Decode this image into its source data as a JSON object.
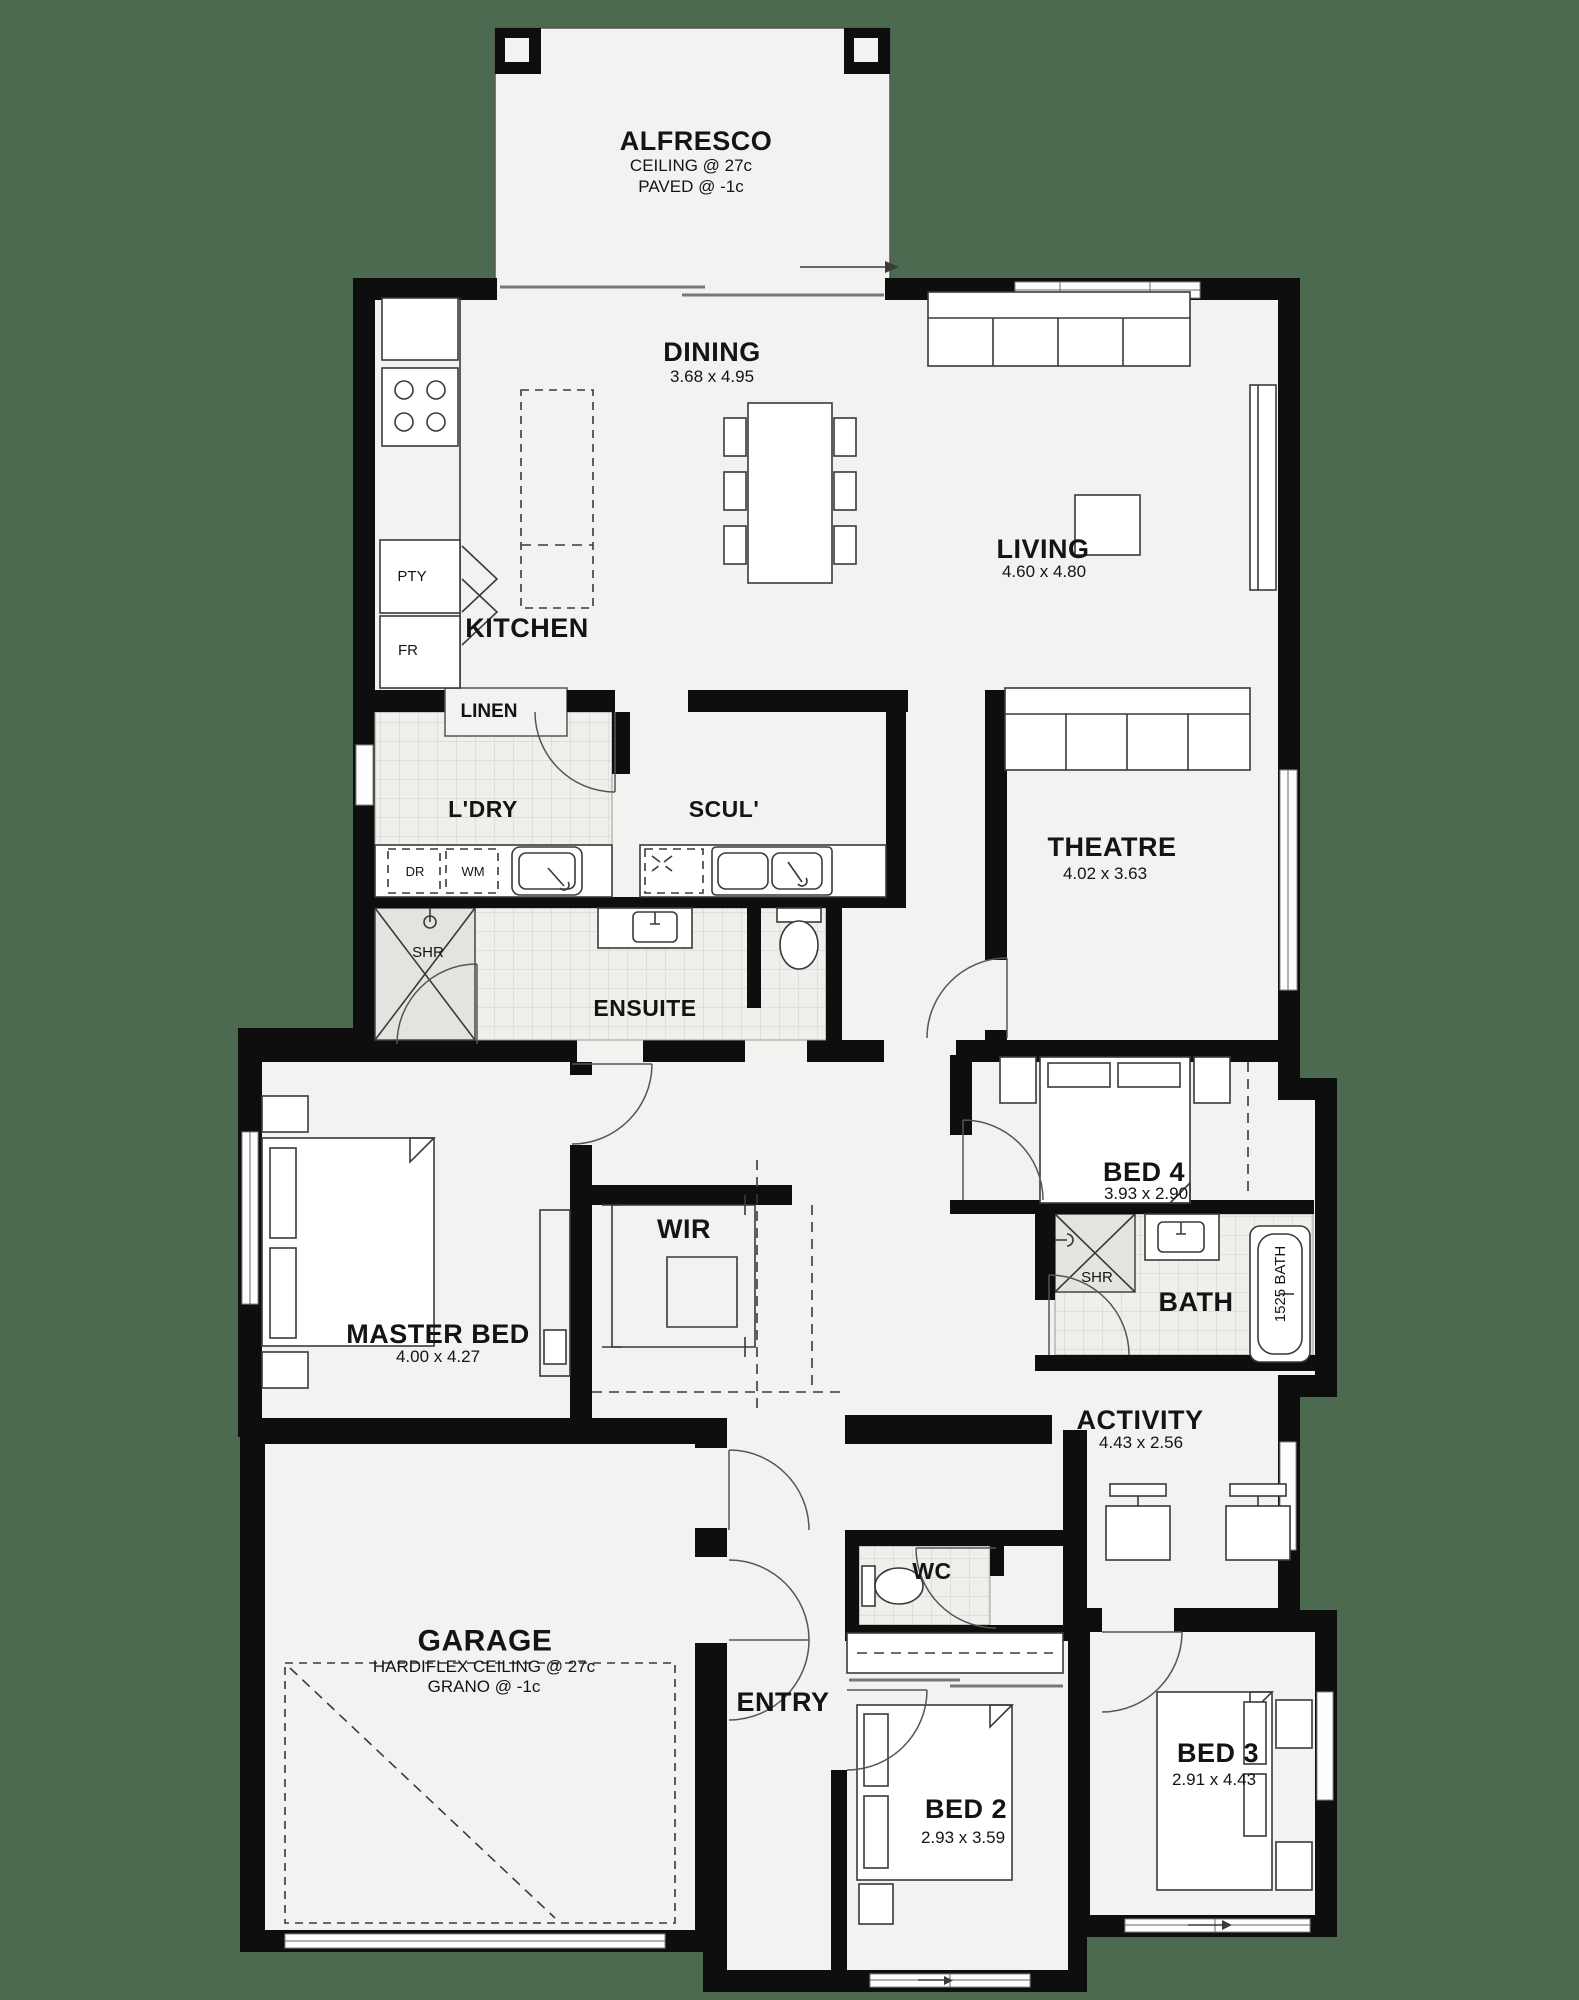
{
  "drawing_type": "residential floor plan",
  "colors": {
    "background": "#4c6a4f",
    "floor": "#f2f2f0",
    "walls": "#0e0e0e",
    "tile_lines": "#d2d2cc",
    "shower_fill": "#e3e3df"
  },
  "rooms": {
    "alfresco": {
      "name": "ALFRESCO",
      "note1": "CEILING @ 27c",
      "note2": "PAVED @ -1c"
    },
    "dining": {
      "name": "DINING",
      "dims": "3.68 x 4.95"
    },
    "living": {
      "name": "LIVING",
      "dims": "4.60 x 4.80"
    },
    "kitchen": {
      "name": "KITCHEN"
    },
    "linen": {
      "name": "LINEN"
    },
    "laundry": {
      "name": "L'DRY"
    },
    "scullery": {
      "name": "SCUL'"
    },
    "theatre": {
      "name": "THEATRE",
      "dims": "4.02 x 3.63"
    },
    "ensuite": {
      "name": "ENSUITE"
    },
    "bed4": {
      "name": "BED 4",
      "dims": "3.93 x 2.90"
    },
    "wir": {
      "name": "WIR"
    },
    "master": {
      "name": "MASTER BED",
      "dims": "4.00 x 4.27"
    },
    "bath": {
      "name": "BATH"
    },
    "activity": {
      "name": "ACTIVITY",
      "dims": "4.43 x 2.56"
    },
    "garage": {
      "name": "GARAGE",
      "note1": "HARDIFLEX CEILING @ 27c",
      "note2": "GRANO @ -1c"
    },
    "wc": {
      "name": "WC"
    },
    "entry": {
      "name": "ENTRY"
    },
    "bed2": {
      "name": "BED 2",
      "dims": "2.93 x 3.59"
    },
    "bed3": {
      "name": "BED 3",
      "dims": "2.91 x 4.43"
    }
  },
  "fixtures": {
    "pantry": "PTY",
    "fridge": "FR",
    "dryer": "DR",
    "washing_machine": "WM",
    "shower_ensuite": "SHR",
    "shower_bath": "SHR",
    "bathtub": "1525 BATH"
  }
}
